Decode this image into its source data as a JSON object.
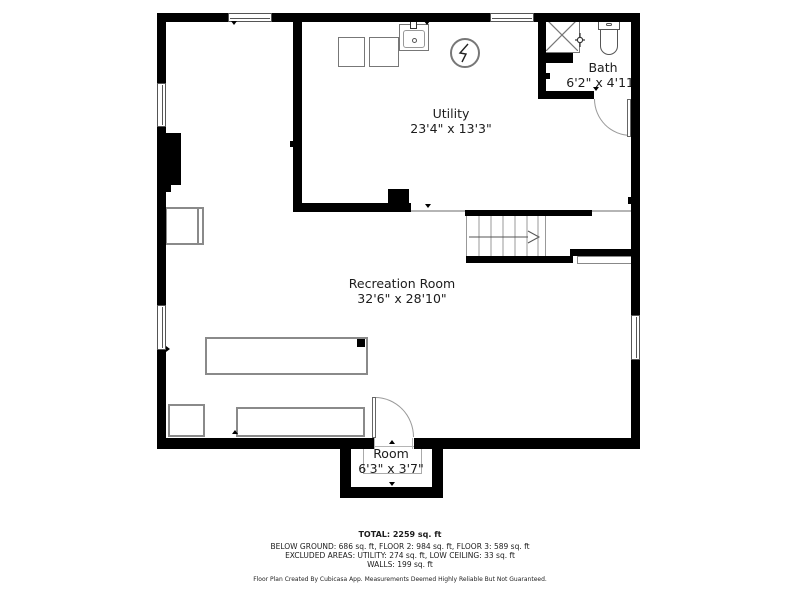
{
  "plan": {
    "rooms": [
      {
        "name": "Utility",
        "dimensions": "23'4\" x 13'3\""
      },
      {
        "name": "Bath",
        "dimensions": "6'2\" x 4'11\""
      },
      {
        "name": "Recreation Room",
        "dimensions": "32'6\" x 28'10\""
      },
      {
        "name": "Room",
        "dimensions": "6'3\" x 3'7\""
      }
    ],
    "fixtures": [
      "washer",
      "dryer",
      "sink",
      "water-heater",
      "shower",
      "toilet",
      "stairs",
      "chimney",
      "doors",
      "windows"
    ]
  },
  "summary": {
    "total": "TOTAL: 2259 sq. ft",
    "areas_line": "BELOW GROUND: 686 sq. ft, FLOOR 2: 984 sq. ft, FLOOR 3: 589 sq. ft",
    "excluded_line": "EXCLUDED AREAS: UTILITY: 274 sq. ft, LOW CEILING: 33 sq. ft",
    "walls_line": "WALLS: 199 sq. ft",
    "disclaimer": "Floor Plan Created By Cubicasa App. Measurements Deemed Highly Reliable But Not Guaranteed."
  },
  "colors": {
    "wall": "#000000",
    "fixture_border": "#777777",
    "furniture_border": "#8a8a8a",
    "light_line": "#b5b5b5",
    "text": "#1c1c1c",
    "background": "#ffffff"
  }
}
